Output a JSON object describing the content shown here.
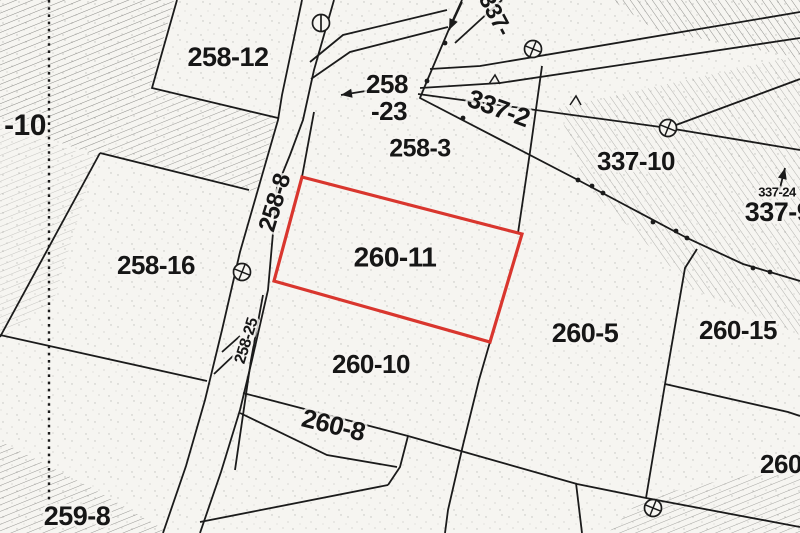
{
  "map": {
    "title": "cadastral-parcel-map",
    "highlighted_parcel": "260-11",
    "colors": {
      "highlight": "#d9362e",
      "line": "#1b1b1b",
      "paper": "#f6f5f1",
      "hatch": "#6f6f6c"
    },
    "labels": [
      {
        "name": "label-neg10",
        "text": "-10",
        "x": 25,
        "y": 127,
        "size": 30,
        "rot": 0
      },
      {
        "name": "label-258-12",
        "text": "258-12",
        "x": 228,
        "y": 59,
        "size": 27,
        "rot": 0
      },
      {
        "name": "label-258-23a",
        "text": "258",
        "x": 387,
        "y": 86,
        "size": 26,
        "rot": 0
      },
      {
        "name": "label-258-23b",
        "text": "-23",
        "x": 389,
        "y": 113,
        "size": 26,
        "rot": 0
      },
      {
        "name": "label-258-3",
        "text": "258-3",
        "x": 420,
        "y": 150,
        "size": 25,
        "rot": 0
      },
      {
        "name": "label-337-top",
        "text": "337-",
        "x": 494,
        "y": 15,
        "size": 23,
        "rot": 62
      },
      {
        "name": "label-337-2",
        "text": "337-2",
        "x": 498,
        "y": 110,
        "size": 26,
        "rot": 20
      },
      {
        "name": "label-337-10",
        "text": "337-10",
        "x": 636,
        "y": 163,
        "size": 26,
        "rot": 0
      },
      {
        "name": "label-337-24",
        "text": "337-24",
        "x": 777,
        "y": 193,
        "size": 13,
        "rot": 0
      },
      {
        "name": "label-337-9",
        "text": "337-9",
        "x": 778,
        "y": 214,
        "size": 27,
        "rot": 0
      },
      {
        "name": "label-258-8",
        "text": "258-8",
        "x": 276,
        "y": 203,
        "size": 24,
        "rot": -73
      },
      {
        "name": "label-258-25",
        "text": "258-25",
        "x": 247,
        "y": 341,
        "size": 16,
        "rot": -73
      },
      {
        "name": "label-258-16",
        "text": "258-16",
        "x": 156,
        "y": 267,
        "size": 26,
        "rot": 0
      },
      {
        "name": "label-259-8",
        "text": "259-8",
        "x": 77,
        "y": 518,
        "size": 27,
        "rot": 0
      },
      {
        "name": "label-260-11",
        "text": "260-11",
        "x": 395,
        "y": 259,
        "size": 28,
        "rot": 0
      },
      {
        "name": "label-260-10",
        "text": "260-10",
        "x": 371,
        "y": 366,
        "size": 26,
        "rot": 0
      },
      {
        "name": "label-260-8",
        "text": "260-8",
        "x": 333,
        "y": 427,
        "size": 26,
        "rot": 14
      },
      {
        "name": "label-260-5",
        "text": "260-5",
        "x": 585,
        "y": 335,
        "size": 27,
        "rot": 0
      },
      {
        "name": "label-260-15",
        "text": "260-15",
        "x": 738,
        "y": 332,
        "size": 26,
        "rot": 0
      },
      {
        "name": "label-260-cut",
        "text": "260",
        "x": 781,
        "y": 466,
        "size": 26,
        "rot": 0
      }
    ],
    "markers": [
      {
        "name": "survey-marker-1",
        "kind": "crossed-circle",
        "x": 533,
        "y": 49
      },
      {
        "name": "survey-marker-2",
        "kind": "crossed-circle",
        "x": 668,
        "y": 128
      },
      {
        "name": "survey-marker-3",
        "kind": "crossed-circle",
        "x": 242,
        "y": 272
      },
      {
        "name": "survey-marker-4",
        "kind": "crossed-circle",
        "x": 653,
        "y": 508
      },
      {
        "name": "survey-marker-5",
        "kind": "lined-circle",
        "x": 321,
        "y": 23
      }
    ],
    "boundary_dots": [
      [
        445,
        43
      ],
      [
        427,
        81
      ],
      [
        463,
        118
      ],
      [
        578,
        180
      ],
      [
        592,
        186
      ],
      [
        603,
        193
      ],
      [
        653,
        222
      ],
      [
        676,
        231
      ],
      [
        687,
        238
      ],
      [
        753,
        268
      ],
      [
        770,
        272
      ]
    ],
    "arrows": [
      {
        "name": "arrow-258-23",
        "x1": 372,
        "y1": 90,
        "x2": 341,
        "y2": 95
      },
      {
        "name": "arrow-337-24",
        "x1": 779,
        "y1": 192,
        "x2": 785,
        "y2": 168
      },
      {
        "name": "arrow-boundary",
        "x1": 462,
        "y1": 2,
        "x2": 449,
        "y2": 30
      }
    ],
    "chevrons": [
      [
        495,
        80
      ],
      [
        576,
        101
      ]
    ]
  }
}
